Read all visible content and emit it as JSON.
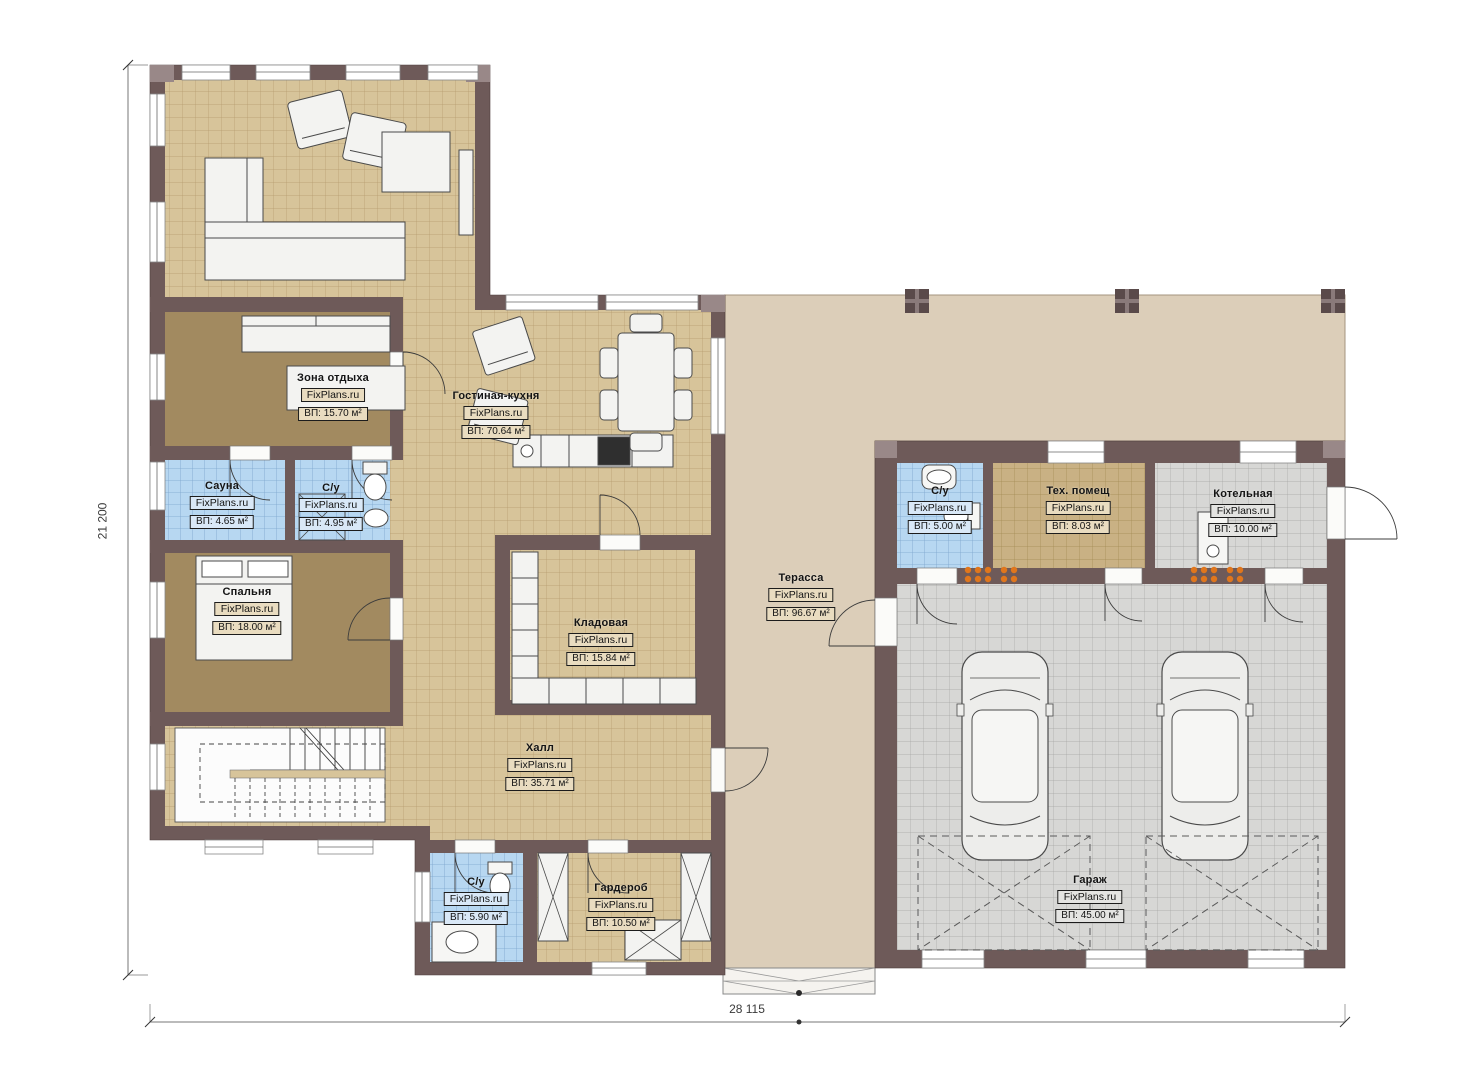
{
  "plan": {
    "watermark": "FixPlans.ru",
    "dimensions": {
      "height_label": "21 200",
      "width_label": "28 115"
    }
  },
  "rooms": [
    {
      "name": "Зона отдыха",
      "watermark": "FixPlans.ru",
      "area": "ВП: 15.70 м²"
    },
    {
      "name": "Гостиная-кухня",
      "watermark": "FixPlans.ru",
      "area": "ВП: 70.64 м²"
    },
    {
      "name": "Сауна",
      "watermark": "FixPlans.ru",
      "area": "ВП: 4.65 м²"
    },
    {
      "name": "С/у",
      "watermark": "FixPlans.ru",
      "area": "ВП: 4.95 м²"
    },
    {
      "name": "Спальня",
      "watermark": "FixPlans.ru",
      "area": "ВП: 18.00 м²"
    },
    {
      "name": "Кладовая",
      "watermark": "FixPlans.ru",
      "area": "ВП: 15.84 м²"
    },
    {
      "name": "Терасса",
      "watermark": "FixPlans.ru",
      "area": "ВП: 96.67 м²"
    },
    {
      "name": "Халл",
      "watermark": "FixPlans.ru",
      "area": "ВП: 35.71 м²"
    },
    {
      "name": "С/у",
      "watermark": "FixPlans.ru",
      "area": "ВП: 5.90 м²"
    },
    {
      "name": "Гардероб",
      "watermark": "FixPlans.ru",
      "area": "ВП: 10.50 м²"
    },
    {
      "name": "С/у",
      "watermark": "FixPlans.ru",
      "area": "ВП: 5.00 м²"
    },
    {
      "name": "Тех. помещ",
      "watermark": "FixPlans.ru",
      "area": "ВП: 8.03 м²"
    },
    {
      "name": "Котельная",
      "watermark": "FixPlans.ru",
      "area": "ВП: 10.00 м²"
    },
    {
      "name": "Гараж",
      "watermark": "FixPlans.ru",
      "area": "ВП: 45.00 м²"
    }
  ],
  "colors": {
    "wall": "#6e5a59",
    "tile_tan": "#d7c49a",
    "tile_blue": "#b7d7f1",
    "tile_gray": "#d7d7d5",
    "carpet_brown": "#a28a60",
    "terrace": "#dcceb9",
    "radiator_orange": "#e0761c"
  }
}
